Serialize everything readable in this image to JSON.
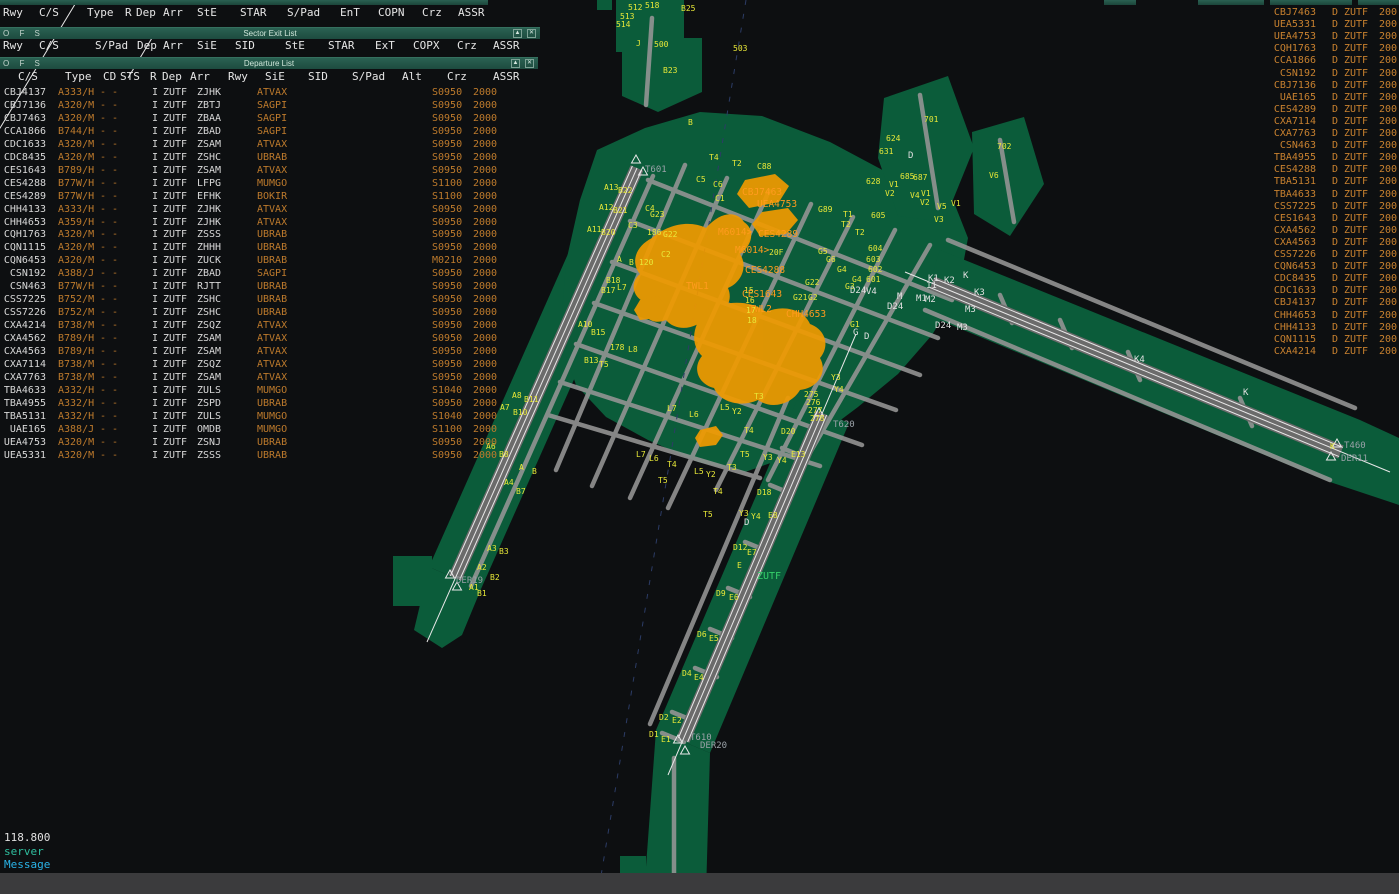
{
  "colors": {
    "titlebar": "#1d4b3f",
    "pad_green": "#0b5c3a",
    "taxiway_gray": "#969696",
    "runway_gray": "#6b6b6b",
    "label_yellow": "#e8e838",
    "datablock_orange": "#ff9b1e",
    "list_amber": "#bd7a2c",
    "cyan": "#2ab4e8",
    "teal": "#2fbf9f",
    "white": "#d8d8d8"
  },
  "window1": {
    "menu": [
      "Rwy",
      "C/S",
      "Type",
      "R",
      "Dep",
      "Arr",
      "StE",
      "STAR",
      "S/Pad",
      "EnT",
      "COPN",
      "Crz",
      "ASSR"
    ]
  },
  "sector_exit_list": {
    "title": "Sector Exit List",
    "ofs": "O F S",
    "min_icon": "▲",
    "close_icon": "✕",
    "menu": [
      "Rwy",
      "C/S",
      "S/Pad",
      "Dep",
      "Arr",
      "SiE",
      "SID",
      "StE",
      "STAR",
      "ExT",
      "COPX",
      "Crz",
      "ASSR"
    ]
  },
  "departure_list": {
    "title": "Departure List",
    "ofs": "O F S",
    "min_icon": "▲",
    "close_icon": "✕",
    "columns": [
      "C/S",
      "Type",
      "CD",
      "STS",
      "R",
      "Dep",
      "Arr",
      "Rwy",
      "SiE",
      "SID",
      "S/Pad",
      "Alt",
      "Crz",
      "ASSR"
    ],
    "shared": {
      "cd": "- -",
      "rule": "I",
      "dep": "ZUTF"
    },
    "rows": [
      [
        "CBJ4137",
        "A333/H",
        "ZJHK",
        "ATVAX",
        "S0950",
        "2000"
      ],
      [
        "CBJ7136",
        "A320/M",
        "ZBTJ",
        "SAGPI",
        "S0950",
        "2000"
      ],
      [
        "CBJ7463",
        "A320/M",
        "ZBAA",
        "SAGPI",
        "S0950",
        "2000"
      ],
      [
        "CCA1866",
        "B744/H",
        "ZBAD",
        "SAGPI",
        "S0950",
        "2000"
      ],
      [
        "CDC1633",
        "A320/M",
        "ZSAM",
        "ATVAX",
        "S0950",
        "2000"
      ],
      [
        "CDC8435",
        "A320/M",
        "ZSHC",
        "UBRAB",
        "S0950",
        "2000"
      ],
      [
        "CES1643",
        "B789/H",
        "ZSAM",
        "ATVAX",
        "S0950",
        "2000"
      ],
      [
        "CES4288",
        "B77W/H",
        "LFPG",
        "MUMGO",
        "S1100",
        "2000"
      ],
      [
        "CES4289",
        "B77W/H",
        "EFHK",
        "BOKIR",
        "S1100",
        "2000"
      ],
      [
        "CHH4133",
        "A333/H",
        "ZJHK",
        "ATVAX",
        "S0950",
        "2000"
      ],
      [
        "CHH4653",
        "A359/H",
        "ZJHK",
        "ATVAX",
        "S0950",
        "2000"
      ],
      [
        "CQH1763",
        "A320/M",
        "ZSSS",
        "UBRAB",
        "S0950",
        "2000"
      ],
      [
        "CQN1115",
        "A320/M",
        "ZHHH",
        "UBRAB",
        "S0950",
        "2000"
      ],
      [
        "CQN6453",
        "A320/M",
        "ZUCK",
        "UBRAB",
        "M0210",
        "2000"
      ],
      [
        "CSN192",
        "A388/J",
        "ZBAD",
        "SAGPI",
        "S0950",
        "2000"
      ],
      [
        "CSN463",
        "B77W/H",
        "RJTT",
        "UBRAB",
        "S0950",
        "2000"
      ],
      [
        "CSS7225",
        "B752/M",
        "ZSHC",
        "UBRAB",
        "S0950",
        "2000"
      ],
      [
        "CSS7226",
        "B752/M",
        "ZSHC",
        "UBRAB",
        "S0950",
        "2000"
      ],
      [
        "CXA4214",
        "B738/M",
        "ZSQZ",
        "ATVAX",
        "S0950",
        "2000"
      ],
      [
        "CXA4562",
        "B789/H",
        "ZSAM",
        "ATVAX",
        "S0950",
        "2000"
      ],
      [
        "CXA4563",
        "B789/H",
        "ZSAM",
        "ATVAX",
        "S0950",
        "2000"
      ],
      [
        "CXA7114",
        "B738/M",
        "ZSQZ",
        "ATVAX",
        "S0950",
        "2000"
      ],
      [
        "CXA7763",
        "B738/M",
        "ZSAM",
        "ATVAX",
        "S0950",
        "2000"
      ],
      [
        "TBA4633",
        "A332/H",
        "ZULS",
        "MUMGO",
        "S1040",
        "2000"
      ],
      [
        "TBA4955",
        "A332/H",
        "ZSPD",
        "UBRAB",
        "S0950",
        "2000"
      ],
      [
        "TBA5131",
        "A332/H",
        "ZULS",
        "MUMGO",
        "S1040",
        "2000"
      ],
      [
        "UAE165",
        "A388/J",
        "OMDB",
        "MUMGO",
        "S1100",
        "2000"
      ],
      [
        "UEA4753",
        "A320/M",
        "ZSNJ",
        "UBRAB",
        "S0950",
        "2000"
      ],
      [
        "UEA5331",
        "A320/M",
        "ZSSS",
        "UBRAB",
        "S0950",
        "2000"
      ]
    ]
  },
  "exit_strip_list": {
    "shared": {
      "d": "D",
      "fix": "ZUTF",
      "alt": "200"
    },
    "rows": [
      "CBJ7463",
      "UEA5331",
      "UEA4753",
      "CQH1763",
      "CCA1866",
      "CSN192",
      "CBJ7136",
      "UAE165",
      "CES4289",
      "CXA7114",
      "CXA7763",
      "CSN463",
      "TBA4955",
      "CES4288",
      "TBA5131",
      "TBA4633",
      "CSS7225",
      "CES1643",
      "CXA4562",
      "CXA4563",
      "CSS7226",
      "CQN6453",
      "CDC8435",
      "CDC1633",
      "CBJ4137",
      "CHH4653",
      "CHH4133",
      "CQN1115",
      "CXA4214"
    ]
  },
  "radio": {
    "frequency": "118.800",
    "line2": "server",
    "line3": "Message"
  },
  "map": {
    "airport": "ZUTF",
    "labels": [
      [
        "512",
        628,
        4,
        "y"
      ],
      [
        "518",
        645,
        2,
        "y"
      ],
      [
        "513",
        620,
        13,
        "y"
      ],
      [
        "514",
        616,
        21,
        "y"
      ],
      [
        "B25",
        681,
        5,
        "y"
      ],
      [
        "J",
        636,
        40,
        "y"
      ],
      [
        "500",
        654,
        41,
        "y"
      ],
      [
        "B23",
        663,
        67,
        "y"
      ],
      [
        "503",
        733,
        45,
        "y"
      ],
      [
        "B",
        688,
        119,
        "y"
      ],
      [
        "701",
        924,
        116,
        "y"
      ],
      [
        "702",
        997,
        143,
        "y"
      ],
      [
        "624",
        886,
        135,
        "y"
      ],
      [
        "631",
        879,
        148,
        "y"
      ],
      [
        "628",
        866,
        178,
        "y"
      ],
      [
        "685",
        900,
        173,
        "y"
      ],
      [
        "687",
        913,
        174,
        "y"
      ],
      [
        "V1",
        889,
        181,
        "y"
      ],
      [
        "V2",
        885,
        190,
        "y"
      ],
      [
        "V6",
        989,
        172,
        "y"
      ],
      [
        "V4",
        910,
        192,
        "y"
      ],
      [
        "V1",
        921,
        190,
        "y"
      ],
      [
        "V2",
        920,
        199,
        "y"
      ],
      [
        "V5",
        937,
        203,
        "y"
      ],
      [
        "V1",
        951,
        200,
        "y"
      ],
      [
        "V3",
        934,
        216,
        "y"
      ],
      [
        "605",
        871,
        212,
        "y"
      ],
      [
        "604",
        868,
        245,
        "y"
      ],
      [
        "603",
        866,
        256,
        "y"
      ],
      [
        "602",
        868,
        266,
        "y"
      ],
      [
        "601",
        866,
        276,
        "y"
      ],
      [
        "G89",
        818,
        206,
        "y"
      ],
      [
        "T1",
        843,
        211,
        "y"
      ],
      [
        "T2",
        841,
        221,
        "y"
      ],
      [
        "T2",
        855,
        229,
        "y"
      ],
      [
        "G4",
        837,
        266,
        "y"
      ],
      [
        "G4",
        852,
        276,
        "y"
      ],
      [
        "G3",
        845,
        283,
        "y"
      ],
      [
        "G22",
        805,
        279,
        "y"
      ],
      [
        "G21",
        793,
        294,
        "y"
      ],
      [
        "G2",
        808,
        294,
        "y"
      ],
      [
        "G1",
        850,
        321,
        "y"
      ],
      [
        "20F",
        769,
        249,
        "y"
      ],
      [
        "G6",
        826,
        256,
        "y"
      ],
      [
        "G5",
        818,
        248,
        "y"
      ],
      [
        "C88",
        757,
        163,
        "y"
      ],
      [
        "T2",
        732,
        160,
        "y"
      ],
      [
        "T4",
        709,
        154,
        "y"
      ],
      [
        "C5",
        696,
        176,
        "y"
      ],
      [
        "C6",
        713,
        181,
        "y"
      ],
      [
        "C1",
        715,
        195,
        "y"
      ],
      [
        "C4",
        645,
        205,
        "y"
      ],
      [
        "G23",
        650,
        211,
        "y"
      ],
      [
        "186",
        647,
        229,
        "y"
      ],
      [
        "G22",
        663,
        231,
        "y"
      ],
      [
        "C2",
        661,
        251,
        "y"
      ],
      [
        "120",
        639,
        259,
        "y"
      ],
      [
        "C3",
        628,
        222,
        "y"
      ],
      [
        "A13",
        604,
        184,
        "y"
      ],
      [
        "B22",
        618,
        187,
        "y"
      ],
      [
        "A12",
        599,
        204,
        "y"
      ],
      [
        "B21",
        613,
        207,
        "y"
      ],
      [
        "A11",
        587,
        226,
        "y"
      ],
      [
        "B20",
        601,
        229,
        "y"
      ],
      [
        "A",
        617,
        256,
        "y"
      ],
      [
        "B",
        629,
        259,
        "y"
      ],
      [
        "B18",
        606,
        277,
        "y"
      ],
      [
        "B17",
        601,
        287,
        "y"
      ],
      [
        "L7",
        617,
        284,
        "y"
      ],
      [
        "A10",
        578,
        321,
        "y"
      ],
      [
        "B15",
        591,
        329,
        "y"
      ],
      [
        "B13",
        584,
        357,
        "y"
      ],
      [
        "T5",
        599,
        361,
        "y"
      ],
      [
        "L8",
        628,
        346,
        "y"
      ],
      [
        "178",
        610,
        344,
        "y"
      ],
      [
        "A8",
        512,
        392,
        "y"
      ],
      [
        "B11",
        524,
        396,
        "y"
      ],
      [
        "A7",
        500,
        404,
        "y"
      ],
      [
        "B10",
        513,
        409,
        "y"
      ],
      [
        "A6",
        486,
        443,
        "y"
      ],
      [
        "B8",
        499,
        451,
        "y"
      ],
      [
        "A4",
        504,
        479,
        "y"
      ],
      [
        "B7",
        516,
        488,
        "y"
      ],
      [
        "A",
        519,
        464,
        "y"
      ],
      [
        "B",
        532,
        468,
        "y"
      ],
      [
        "A3",
        487,
        545,
        "y"
      ],
      [
        "B3",
        499,
        548,
        "y"
      ],
      [
        "A2",
        477,
        564,
        "y"
      ],
      [
        "B2",
        490,
        574,
        "y"
      ],
      [
        "A1",
        469,
        584,
        "y"
      ],
      [
        "B1",
        477,
        590,
        "y"
      ],
      [
        "L7",
        636,
        451,
        "y"
      ],
      [
        "L6",
        649,
        455,
        "y"
      ],
      [
        "T4",
        667,
        461,
        "y"
      ],
      [
        "T5",
        658,
        477,
        "y"
      ],
      [
        "L5",
        694,
        468,
        "y"
      ],
      [
        "Y2",
        706,
        471,
        "y"
      ],
      [
        "T3",
        727,
        464,
        "y"
      ],
      [
        "T4",
        713,
        488,
        "y"
      ],
      [
        "T5",
        703,
        511,
        "y"
      ],
      [
        "Y3",
        739,
        510,
        "y"
      ],
      [
        "Y4",
        751,
        513,
        "y"
      ],
      [
        "T3",
        754,
        393,
        "y"
      ],
      [
        "L5",
        720,
        404,
        "y"
      ],
      [
        "Y2",
        732,
        408,
        "y"
      ],
      [
        "T4",
        744,
        427,
        "y"
      ],
      [
        "T5",
        740,
        451,
        "y"
      ],
      [
        "Y3",
        763,
        454,
        "y"
      ],
      [
        "Y4",
        777,
        457,
        "y"
      ],
      [
        "L6",
        689,
        411,
        "y"
      ],
      [
        "L7",
        667,
        405,
        "y"
      ],
      [
        "275",
        804,
        391,
        "y"
      ],
      [
        "276",
        806,
        399,
        "y"
      ],
      [
        "277",
        808,
        407,
        "y"
      ],
      [
        "278",
        810,
        415,
        "y"
      ],
      [
        "Y3",
        831,
        374,
        "y"
      ],
      [
        "Y4",
        834,
        386,
        "y"
      ],
      [
        "D20",
        781,
        428,
        "y"
      ],
      [
        "E13",
        791,
        451,
        "y"
      ],
      [
        "D18",
        757,
        489,
        "y"
      ],
      [
        "E8",
        768,
        512,
        "y"
      ],
      [
        "D12",
        733,
        544,
        "y"
      ],
      [
        "E7",
        747,
        549,
        "y"
      ],
      [
        "E",
        737,
        562,
        "y"
      ],
      [
        "D9",
        716,
        590,
        "y"
      ],
      [
        "E6",
        729,
        594,
        "y"
      ],
      [
        "D6",
        697,
        631,
        "y"
      ],
      [
        "E5",
        709,
        635,
        "y"
      ],
      [
        "D4",
        682,
        670,
        "y"
      ],
      [
        "E4",
        694,
        674,
        "y"
      ],
      [
        "D2",
        659,
        714,
        "y"
      ],
      [
        "E2",
        672,
        717,
        "y"
      ],
      [
        "D1",
        649,
        731,
        "y"
      ],
      [
        "E1",
        661,
        736,
        "y"
      ],
      [
        "K",
        1330,
        443,
        "y"
      ],
      [
        "15",
        744,
        287,
        "y"
      ],
      [
        "16",
        745,
        297,
        "y"
      ],
      [
        "17",
        746,
        307,
        "y"
      ],
      [
        "18",
        747,
        317,
        "y"
      ],
      [
        "D",
        908,
        152,
        "w"
      ],
      [
        "D24",
        850,
        287,
        "w"
      ],
      [
        "V4",
        866,
        288,
        "w"
      ],
      [
        "M",
        897,
        293,
        "w"
      ],
      [
        "M1",
        916,
        295,
        "w"
      ],
      [
        "M2",
        925,
        296,
        "w"
      ],
      [
        "D24",
        887,
        303,
        "w"
      ],
      [
        "M3",
        965,
        306,
        "w"
      ],
      [
        "D24",
        935,
        322,
        "w"
      ],
      [
        "M3",
        957,
        324,
        "w"
      ],
      [
        "K1",
        928,
        275,
        "w"
      ],
      [
        "K2",
        944,
        277,
        "w"
      ],
      [
        "K",
        963,
        272,
        "w"
      ],
      [
        "K3",
        974,
        289,
        "w"
      ],
      [
        "11",
        926,
        282,
        "w"
      ],
      [
        "K4",
        1134,
        356,
        "w"
      ],
      [
        "K",
        1243,
        389,
        "w"
      ],
      [
        "G",
        853,
        329,
        "w"
      ],
      [
        "D",
        864,
        333,
        "w"
      ],
      [
        "D",
        744,
        519,
        "w"
      ],
      [
        "T601",
        645,
        166,
        "g"
      ],
      [
        "T620",
        833,
        421,
        "g"
      ],
      [
        "T610",
        690,
        734,
        "g"
      ],
      [
        "T460",
        1344,
        442,
        "g"
      ],
      [
        "DER11",
        1341,
        455,
        "g"
      ],
      [
        "DER20",
        700,
        742,
        "g"
      ],
      [
        "DER19",
        456,
        577,
        "g"
      ],
      [
        "ZUTF",
        757,
        573,
        "c"
      ],
      [
        "CES4289",
        758,
        231,
        "o"
      ],
      [
        "M6014>",
        718,
        229,
        "o"
      ],
      [
        "CES4288",
        745,
        267,
        "o"
      ],
      [
        "CES1643",
        742,
        291,
        "o"
      ],
      [
        "TWL2",
        749,
        306,
        "o"
      ],
      [
        "TWL1",
        686,
        283,
        "o"
      ],
      [
        "M6014>",
        735,
        247,
        "o"
      ],
      [
        "CBJ7463",
        742,
        189,
        "o"
      ],
      [
        "UEA4753",
        757,
        201,
        "o"
      ],
      [
        "CHH4653",
        786,
        311,
        "o"
      ]
    ],
    "triangles": [
      [
        636,
        160
      ],
      [
        643,
        172
      ],
      [
        450,
        575
      ],
      [
        457,
        587
      ],
      [
        819,
        413
      ],
      [
        678,
        740
      ],
      [
        685,
        751
      ],
      [
        1337,
        444
      ],
      [
        1331,
        457
      ]
    ]
  }
}
